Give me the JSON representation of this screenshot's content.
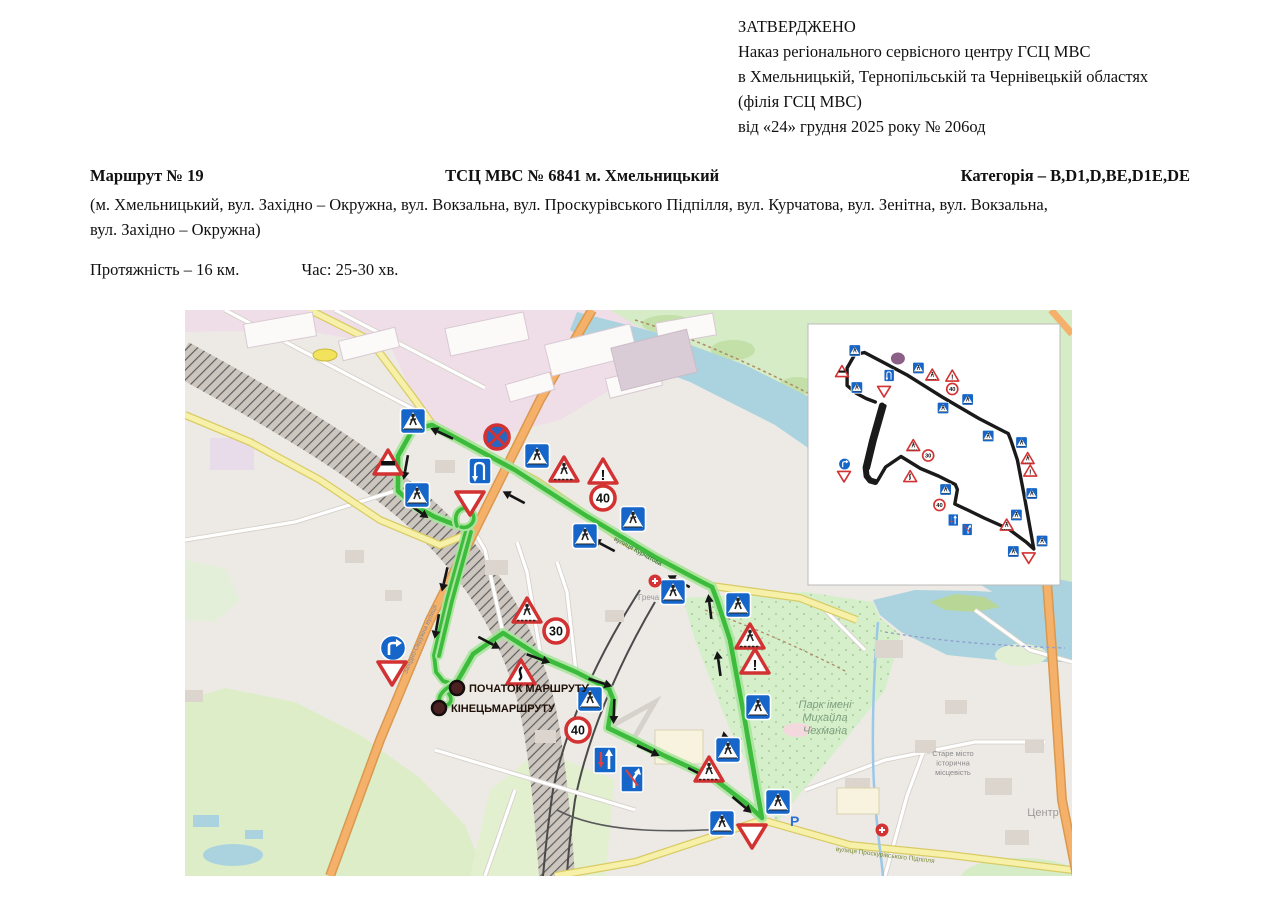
{
  "header": {
    "line1": "ЗАТВЕРДЖЕНО",
    "line2": "Наказ регіонального сервісного центру ГСЦ МВС",
    "line3": "в Хмельницькій, Тернопільській та Чернівецькій областях",
    "line4": "(філія ГСЦ МВС)",
    "line5": "від «24» грудня 2025 року № 206од"
  },
  "route_info": {
    "number": "Маршрут № 19",
    "center": "ТСЦ МВС № 6841 м. Хмельницький",
    "category": "Категорія – B,D1,D,BE,D1E,DE",
    "streets_line1": "(м. Хмельницький, вул. Західно – Окружна, вул. Вокзальна, вул. Проскурівського Підпілля,  вул. Курчатова, вул. Зенітна,  вул. Вокзальна,",
    "streets_line2": "вул. Західно  – Окружна)",
    "length": "Протяжність – 16 км.",
    "time": "Час: 25-30 хв."
  },
  "map": {
    "colors": {
      "route_core": "#3dbb3d",
      "route_halo": "#a9e49d",
      "sign_red": "#d23232",
      "sign_blue": "#1566c8",
      "water": "#aad3df",
      "park": "#d4efca",
      "pink": "#efdee8",
      "yellow_road": "#f7f0a8",
      "orange_road": "#f5b069",
      "base": "#edeae6"
    },
    "markers": {
      "start_label": "ПОЧАТОК МАРШРУТУ",
      "end_label": "КІНЕЦЬМАРШРУТУ",
      "start": {
        "x": 272,
        "y": 378
      },
      "end": {
        "x": 254,
        "y": 398
      },
      "parking_label": "P",
      "parking": {
        "x": 605,
        "y": 516
      }
    },
    "labels": {
      "park": [
        "Парк імені",
        "Михайла",
        "Чехмана"
      ],
      "park_pos": {
        "x": 640,
        "y": 398
      },
      "old_town": [
        "Старе місто",
        "історична",
        "місцевість"
      ],
      "old_town_pos": {
        "x": 768,
        "y": 446
      },
      "center": "Центр",
      "center_pos": {
        "x": 858,
        "y": 506
      },
      "district": "Гречани",
      "district_pos": {
        "x": 468,
        "y": 290
      },
      "street_orange": "Західно-Окружна вулиця",
      "street_orange_pos": {
        "x": 237,
        "y": 330,
        "rot": -66
      },
      "street_bottom": "вулиця Проскурівського Підпілля",
      "street_bottom_pos": {
        "x": 700,
        "y": 547,
        "rot": 7
      },
      "street_route": "вулиця Курчатова",
      "street_route_pos": {
        "x": 452,
        "y": 243,
        "rot": 29
      }
    },
    "route": {
      "loop": [
        [
          272,
          372
        ],
        [
          288,
          344
        ],
        [
          318,
          323
        ],
        [
          356,
          347
        ],
        [
          391,
          362
        ],
        [
          424,
          379
        ],
        [
          428,
          389
        ],
        [
          423,
          418
        ],
        [
          448,
          430
        ],
        [
          480,
          446
        ],
        [
          528,
          468
        ],
        [
          562,
          494
        ],
        [
          577,
          508
        ],
        [
          572,
          480
        ],
        [
          558,
          400
        ],
        [
          545,
          330
        ],
        [
          532,
          290
        ],
        [
          527,
          277
        ],
        [
          517,
          272
        ],
        [
          470,
          247
        ],
        [
          400,
          205
        ],
        [
          330,
          160
        ],
        [
          284,
          135
        ],
        [
          247,
          115
        ],
        [
          228,
          119
        ],
        [
          213,
          146
        ],
        [
          213,
          181
        ],
        [
          230,
          196
        ],
        [
          250,
          207
        ],
        [
          268,
          214
        ]
      ],
      "teardrop": "M 272,216 C 266,200 282,192 288,204 C 291,212 284,219 276,217",
      "double_a": [
        [
          281,
          221
        ],
        [
          262,
          290
        ],
        [
          249,
          345
        ],
        [
          251,
          362
        ],
        [
          258,
          371
        ],
        [
          268,
          374
        ]
      ],
      "double_b": [
        [
          286,
          222
        ],
        [
          267,
          291
        ],
        [
          254,
          346
        ]
      ],
      "hook": "M 268,374 C 258,380 250,388 257,394 C 263,398 269,391 264,384"
    },
    "arrows": [
      {
        "x": 258,
        "y": 124,
        "a": 205
      },
      {
        "x": 330,
        "y": 188,
        "a": 208
      },
      {
        "x": 420,
        "y": 236,
        "a": 208
      },
      {
        "x": 495,
        "y": 272,
        "a": 208
      },
      {
        "x": 221,
        "y": 156,
        "a": 100
      },
      {
        "x": 232,
        "y": 200,
        "a": 35
      },
      {
        "x": 260,
        "y": 268,
        "a": 103
      },
      {
        "x": 252,
        "y": 315,
        "a": 100
      },
      {
        "x": 303,
        "y": 332,
        "a": 28
      },
      {
        "x": 352,
        "y": 348,
        "a": 20
      },
      {
        "x": 414,
        "y": 372,
        "a": 18
      },
      {
        "x": 429,
        "y": 400,
        "a": 92
      },
      {
        "x": 462,
        "y": 440,
        "a": 25
      },
      {
        "x": 513,
        "y": 463,
        "a": 27
      },
      {
        "x": 556,
        "y": 494,
        "a": 40
      },
      {
        "x": 541,
        "y": 435,
        "a": 260
      },
      {
        "x": 534,
        "y": 355,
        "a": 262
      },
      {
        "x": 525,
        "y": 298,
        "a": 263
      }
    ],
    "signs": [
      {
        "x": 228,
        "y": 111,
        "t": "ped"
      },
      {
        "x": 203,
        "y": 153,
        "t": "rail"
      },
      {
        "x": 232,
        "y": 185,
        "t": "ped"
      },
      {
        "x": 312,
        "y": 127,
        "t": "nostop"
      },
      {
        "x": 295,
        "y": 161,
        "t": "uturn"
      },
      {
        "x": 285,
        "y": 192,
        "t": "yield"
      },
      {
        "x": 352,
        "y": 146,
        "t": "ped"
      },
      {
        "x": 379,
        "y": 160,
        "t": "pedwarn"
      },
      {
        "x": 418,
        "y": 162,
        "t": "excl"
      },
      {
        "x": 418,
        "y": 188,
        "t": "s40"
      },
      {
        "x": 448,
        "y": 209,
        "t": "ped"
      },
      {
        "x": 400,
        "y": 226,
        "t": "ped"
      },
      {
        "x": 488,
        "y": 282,
        "t": "ped"
      },
      {
        "x": 553,
        "y": 295,
        "t": "ped"
      },
      {
        "x": 565,
        "y": 327,
        "t": "pedwarn"
      },
      {
        "x": 570,
        "y": 352,
        "t": "excl"
      },
      {
        "x": 342,
        "y": 301,
        "t": "pedwarn"
      },
      {
        "x": 371,
        "y": 321,
        "t": "s30"
      },
      {
        "x": 336,
        "y": 363,
        "t": "curve"
      },
      {
        "x": 405,
        "y": 389,
        "t": "ped"
      },
      {
        "x": 393,
        "y": 420,
        "t": "s40"
      },
      {
        "x": 420,
        "y": 450,
        "t": "lane1"
      },
      {
        "x": 447,
        "y": 469,
        "t": "lane2"
      },
      {
        "x": 208,
        "y": 338,
        "t": "turnR"
      },
      {
        "x": 207,
        "y": 362,
        "t": "yield"
      },
      {
        "x": 573,
        "y": 397,
        "t": "ped"
      },
      {
        "x": 543,
        "y": 440,
        "t": "ped"
      },
      {
        "x": 524,
        "y": 460,
        "t": "pedwarn"
      },
      {
        "x": 593,
        "y": 492,
        "t": "ped"
      },
      {
        "x": 537,
        "y": 513,
        "t": "ped"
      },
      {
        "x": 567,
        "y": 525,
        "t": "yield"
      }
    ],
    "pois": [
      {
        "x": 470,
        "y": 271,
        "t": "hospital"
      },
      {
        "x": 697,
        "y": 520,
        "t": "hospital"
      }
    ],
    "speed_values": {
      "s30": "30",
      "s40": "40"
    },
    "inset": {
      "x": 623,
      "y": 14,
      "w": 252,
      "h": 261
    }
  }
}
